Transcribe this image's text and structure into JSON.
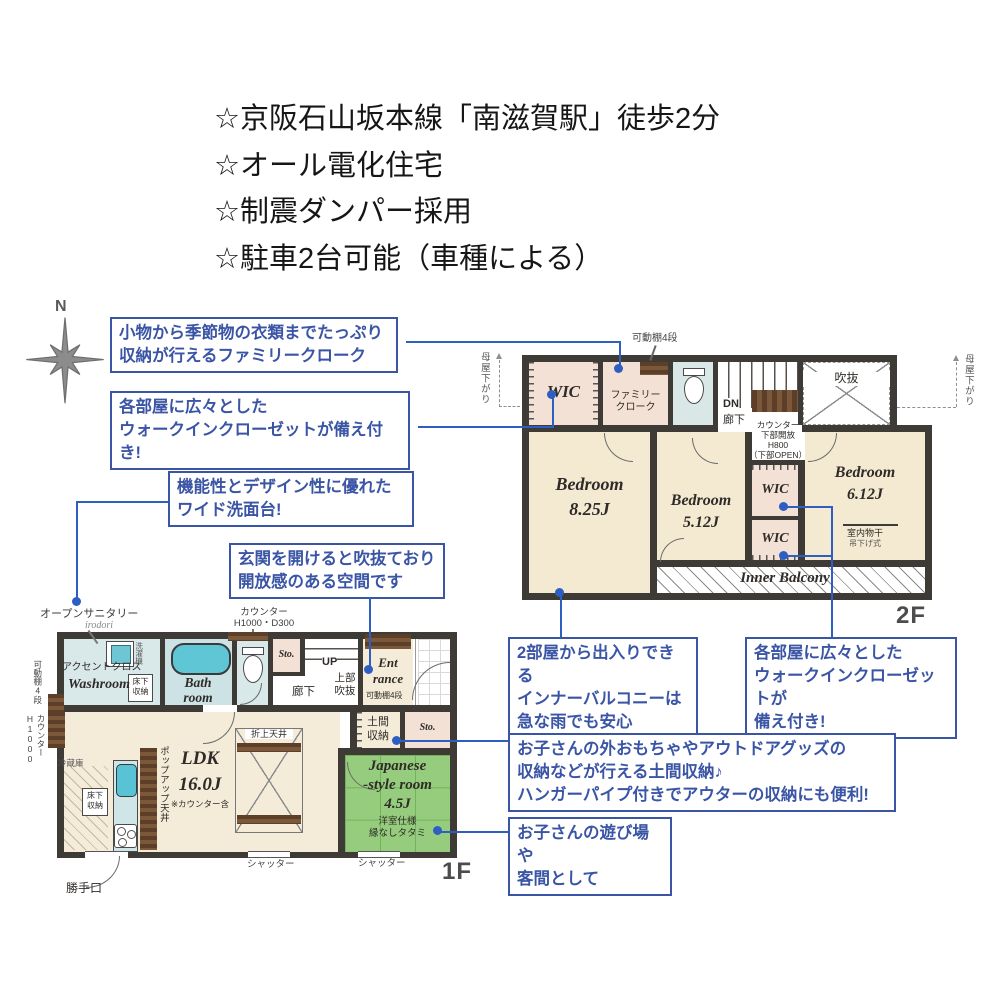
{
  "header": {
    "lines": [
      "☆京阪石山坂本線「南滋賀駅」徒歩2分",
      "☆オール電化住宅",
      "☆制震ダンパー採用",
      "☆駐車2台可能（車種による）"
    ]
  },
  "compass": {
    "north": "N"
  },
  "callouts": {
    "family_cloak": "小物から季節物の衣類までたっぷり\n収納が行えるファミリークローク",
    "wic_left": "各部屋に広々とした\nウォークインクローゼットが備え付き!",
    "vanity": "機能性とデザイン性に優れた\nワイド洗面台!",
    "entrance_void": "玄関を開けると吹抜ており\n開放感のある空間です",
    "inner_balcony": "2部屋から出入りできる\nインナーバルコニーは\n急な雨でも安心",
    "wic_right": "各部屋に広々とした\nウォークインクローゼットが\n備え付き!",
    "doma": "お子さんの外おもちゃやアウトドアグッズの\n収納などが行える土間収納♪\nハンガーパイプ付きでアウターの収納にも便利!",
    "guest": "お子さんの遊び場や\n客間として"
  },
  "f2": {
    "floor": "2F",
    "wic_a": "WIC",
    "wic_b": "WIC",
    "wic_c": "WIC",
    "family_cloak": "ファミリー\nクローク",
    "shelf": "可動棚4段",
    "moya_left": "母屋下がり",
    "moya_right": "母屋下がり",
    "void": "吹抜",
    "dn": "DN",
    "hall": "廊下",
    "counter": "カウンター\n下部開放\nH800\n（下部OPEN）",
    "bed1": "Bedroom\n8.25J",
    "bed2": "Bedroom\n5.12J",
    "bed3": "Bedroom\n6.12J",
    "monohoshi": "室内物干",
    "monohoshi_sub": "吊下げ式",
    "balcony": "Inner Balcony"
  },
  "f1": {
    "floor": "1F",
    "open_sanitary": "オープンサニタリー",
    "open_sanitary_sub": "irodori",
    "counter_top": "カウンター\nH1000・D300",
    "accent": "アクセントクロス",
    "washroom": "Washroom",
    "washer": "洗濯機",
    "underfloor_a": "床下\n収納",
    "bath": "Bath\nroom",
    "sto_a": "Sto.",
    "sto_b": "Sto.",
    "hall": "廊下",
    "up": "UP",
    "upper_void": "上部\n吹抜",
    "entrance": "Ent\nrance",
    "shelf": "可動棚4段",
    "doma": "土間\n収納",
    "ldk": "LDK\n16.0J",
    "ldk_sub": "※カウンター含",
    "oriage": "折上天井",
    "popup": "ポップアップ天井",
    "fridge": "冷蔵庫",
    "underfloor_b": "床下\n収納",
    "jroom": "Japanese\n-style room\n4.5J",
    "jroom_sub": "洋室仕様\n縁なしタタミ",
    "shutter_a": "シャッター",
    "shutter_b": "シャッター",
    "backdoor": "勝手口",
    "left_shelf": "可動棚4段",
    "left_counter": "カウンター\nH1000"
  },
  "colors": {
    "accent_blue": "#3a55a5",
    "line_blue": "#2d5fc2",
    "wall": "#3e3a35",
    "tatami_green": "#96cc7e",
    "floor_cream": "#f4ecd9",
    "closet_pink": "#f2e1d4",
    "wet_blue": "#d9e8e9",
    "wood_brown": "#5d3f29"
  }
}
